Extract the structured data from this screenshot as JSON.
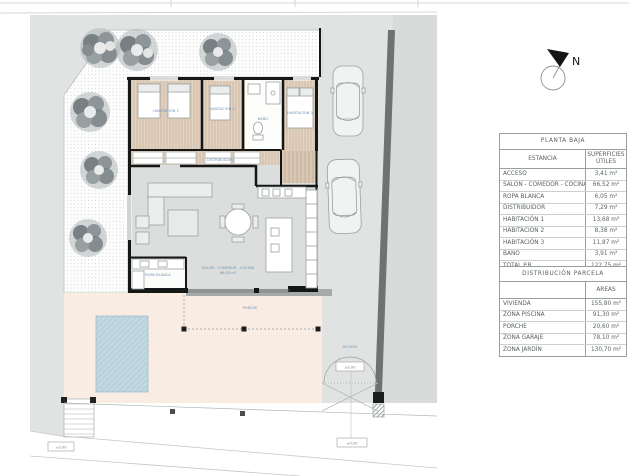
{
  "north": {
    "label": "N"
  },
  "colors": {
    "accent_label": "#6f93b8",
    "pool": "#c3d9e2",
    "terrace": "#f9ece3",
    "bedroom_floor": "#d9c7b3",
    "living_floor": "#dcdedd",
    "street_gray": "#e1e3e2",
    "wall_black": "#151716",
    "boundary_dark_gray": "#6f7271"
  },
  "tables": {
    "planta_baja": {
      "title": "PLANTA BAJA",
      "col_room": "ESTANCIA",
      "col_area": "SUPERFICIES ÚTILES",
      "rows": [
        {
          "label": "ACCESO",
          "value": "3,41 m²"
        },
        {
          "label": "SALÓN - COMEDOR - COCINA",
          "value": "66,52 m²"
        },
        {
          "label": "ROPA BLANCA",
          "value": "6,05 m²"
        },
        {
          "label": "DISTRIBUIDOR",
          "value": "7,29 m²"
        },
        {
          "label": "HABITACIÓN 1",
          "value": "13,68 m²"
        },
        {
          "label": "HABITACIÓN 2",
          "value": "8,38 m²"
        },
        {
          "label": "HABITACIÓN 3",
          "value": "11,87 m²"
        },
        {
          "label": "BAÑO",
          "value": "3,91 m²"
        },
        {
          "label": "TOTAL P.B.",
          "value": "122,75 m²"
        }
      ]
    },
    "parcela": {
      "title": "DISTRIBUCIÓN PARCELA",
      "col_area": "AREAS",
      "rows": [
        {
          "label": "VIVIENDA",
          "value": "155,80 m²"
        },
        {
          "label": "ZONA PISCINA",
          "value": "91,30 m²"
        },
        {
          "label": "PORCHE",
          "value": "20,60 m²"
        },
        {
          "label": "ZONA GARAJE",
          "value": "78,10 m²"
        },
        {
          "label": "ZONA JARDÍN",
          "value": "130,70 m²"
        }
      ]
    }
  },
  "plan": {
    "labels": {
      "hab1": "HABITACIÓN 1",
      "hab2": "HABITACIÓN 2",
      "hab3": "HABITACIÓN 3",
      "bano": "BAÑO",
      "ropa": "ROPA BLANCA",
      "distribuidor": "DISTRIBUIDOR",
      "salon": "SALÓN - COMEDOR - COCINA",
      "salon_area": "66,52 m²",
      "acceso": "ACCESO",
      "porche": "PORCHE"
    },
    "level_marks": {
      "gate": "±0,00",
      "street": "±0,00",
      "stairs": "±0,00"
    }
  }
}
